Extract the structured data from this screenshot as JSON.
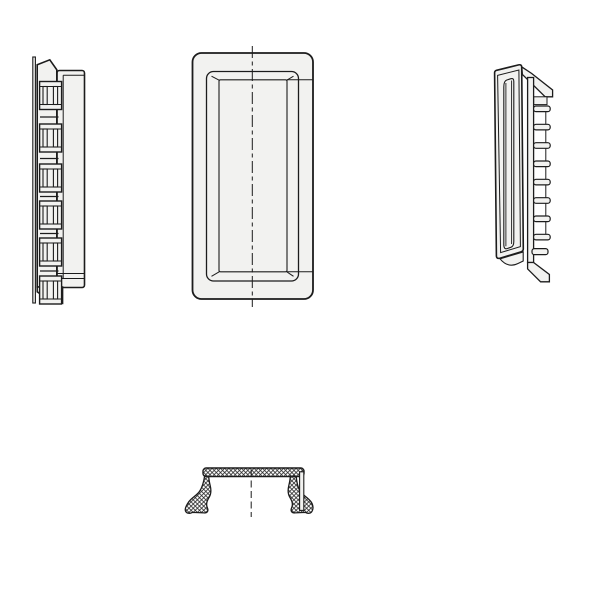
{
  "drawing": {
    "background_color": "#ffffff",
    "line_color": "#1c1c1c",
    "fill_color": "#f2f2f0",
    "hatch_color": "#2a2a2a",
    "views": [
      {
        "id": "side-view-left",
        "label": "left-side-profile-with-snap-lugs"
      },
      {
        "id": "front-view",
        "label": "front-view-recessed-tray"
      },
      {
        "id": "side-view-right",
        "label": "right-side-profile-with-ribs"
      },
      {
        "id": "bottom-section-view",
        "label": "bottom-cross-section-hatched"
      }
    ],
    "left_view": {
      "lug_ys": [
        81.5,
        124,
        164,
        201,
        238,
        276
      ],
      "lug_x": 39.6,
      "lug_w": 22,
      "lug_h": 28,
      "connector_ys": [
        117,
        158.5,
        196.5,
        233.5,
        271
      ]
    },
    "right_view": {
      "rib_ys": [
        106,
        124.3,
        142.7,
        161,
        179.3,
        197.7,
        216,
        234.3
      ],
      "rib_x": 533.6,
      "rib_w": 16.6,
      "rib_h": 5.6,
      "rail_x": 545.8
    },
    "centerlines": {
      "front_x": 252.3,
      "section_x": 251.2
    }
  }
}
